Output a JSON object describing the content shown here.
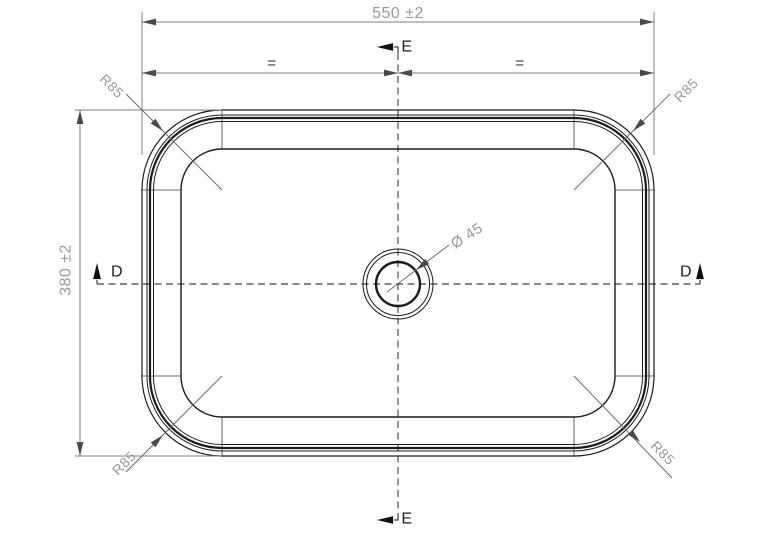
{
  "drawing": {
    "kind": "technical-drawing-top-view-basin",
    "dimensions": {
      "width": "550 ±2",
      "height": "380 ±2",
      "drain_diameter": "Ø 45",
      "corner_radii": {
        "top_left": "R85",
        "top_right": "R85",
        "bottom_left": "R85",
        "bottom_right": "R85"
      },
      "symmetry": {
        "left": "=",
        "right": "="
      }
    },
    "section_markers": {
      "d_left": "D",
      "d_right": "D",
      "e_top": "E",
      "e_bottom": "E"
    },
    "colors": {
      "background": "#ffffff",
      "part_line": "#1c1c1c",
      "dimension_line": "#7f7f7f",
      "dimension_text": "#9a9a9a",
      "equality_text": "#3d3d3d",
      "section_text": "#1c1c1c"
    }
  }
}
